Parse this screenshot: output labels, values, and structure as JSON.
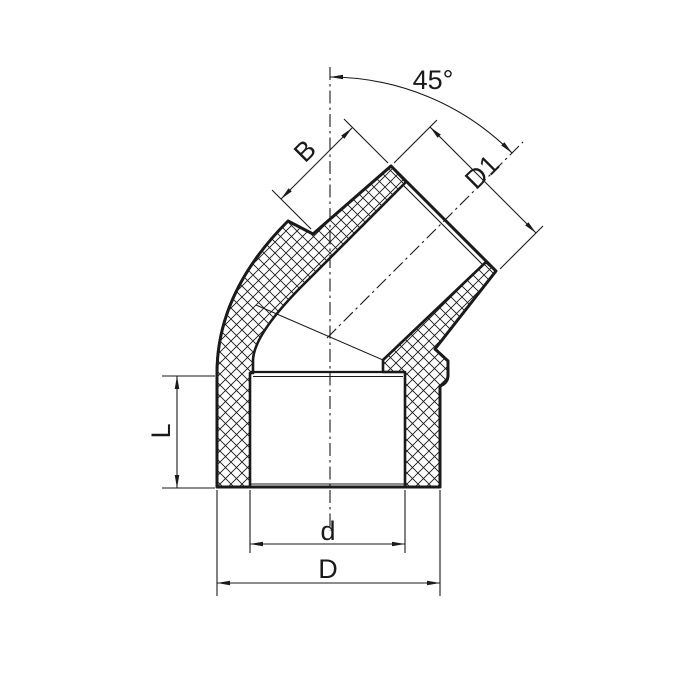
{
  "drawing": {
    "description": "Technical section drawing of a 45 degree pipe elbow fitting",
    "colors": {
      "line": "#1a1a1a",
      "background": "#ffffff"
    },
    "dimension_labels": {
      "angle": "45°",
      "socket_depth_angled": "B",
      "outer_diameter_angled": "D1",
      "socket_depth_bottom": "L",
      "inner_diameter_bottom": "d",
      "outer_diameter_bottom": "D"
    }
  }
}
